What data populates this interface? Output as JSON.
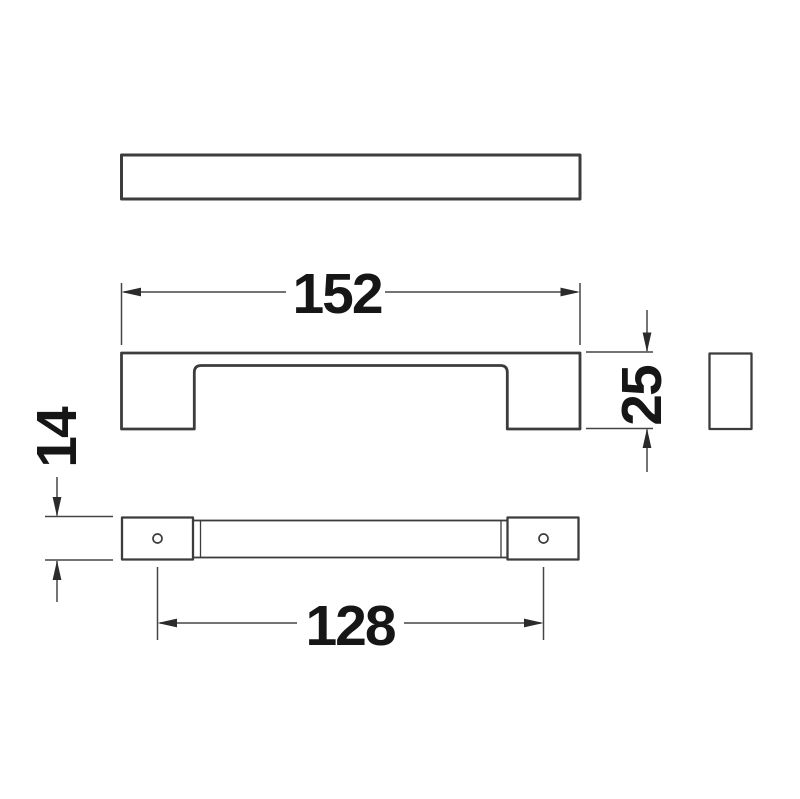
{
  "drawing": {
    "kind": "technical-dimension-drawing",
    "subject": "rectangular-bar-pull-handle",
    "dimension_labels": {
      "overall_length": "152",
      "height": "25",
      "depth": "14",
      "hole_centres": "128"
    },
    "colors": {
      "outline": "#3c3c3c",
      "dimension_line": "#454545",
      "text": "#161616",
      "background": "#ffffff"
    }
  }
}
